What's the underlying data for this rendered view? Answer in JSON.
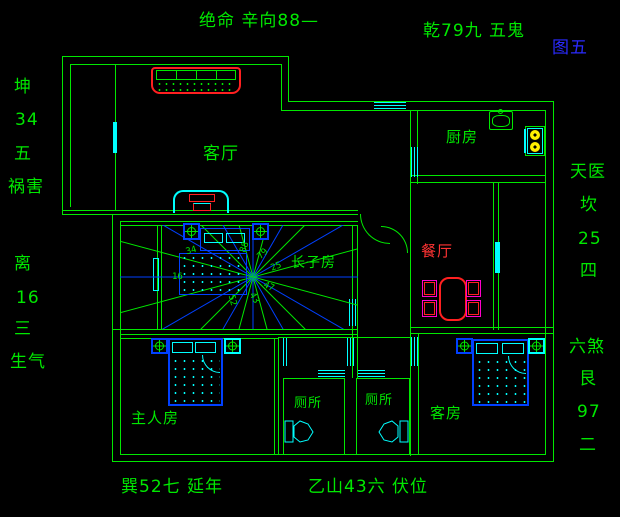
{
  "figure_label": "图五",
  "annotations": {
    "top_left": "绝命 辛向88—",
    "top_right": "乾79九 五鬼",
    "bottom_left": "巽52七 延年",
    "bottom_right": "乙山43六 伏位",
    "left_upper": [
      "坤",
      "34",
      "五",
      "祸害"
    ],
    "left_lower": [
      "离",
      "16",
      "三",
      "生气"
    ],
    "right_upper": [
      "天医",
      "坎",
      "25",
      "四"
    ],
    "right_lower": [
      "六煞",
      "艮",
      "97",
      "二"
    ]
  },
  "rooms": {
    "living": "客厅",
    "kitchen": "厨房",
    "dining": "餐厅",
    "eldest_son": "长子房",
    "master": "主人房",
    "toilet_left": "厕所",
    "toilet_right": "厕所",
    "guest": "客房"
  },
  "compass_numbers": {
    "n88": "88",
    "n79": "79",
    "n25": "25",
    "n47": "47",
    "n43": "43",
    "n52": "52",
    "n34": "34",
    "n16": "16"
  },
  "colors": {
    "wall_green": "#00e800",
    "window_cyan": "#00ffff",
    "furniture_blue": "#0040ff",
    "highlight_red": "#ff2020",
    "chair_magenta": "#ff00cc",
    "burner_yellow": "#ffee00",
    "figure_label_blue": "#2a2aff",
    "dining_label_red": "#ff3333",
    "background": "#000000"
  }
}
